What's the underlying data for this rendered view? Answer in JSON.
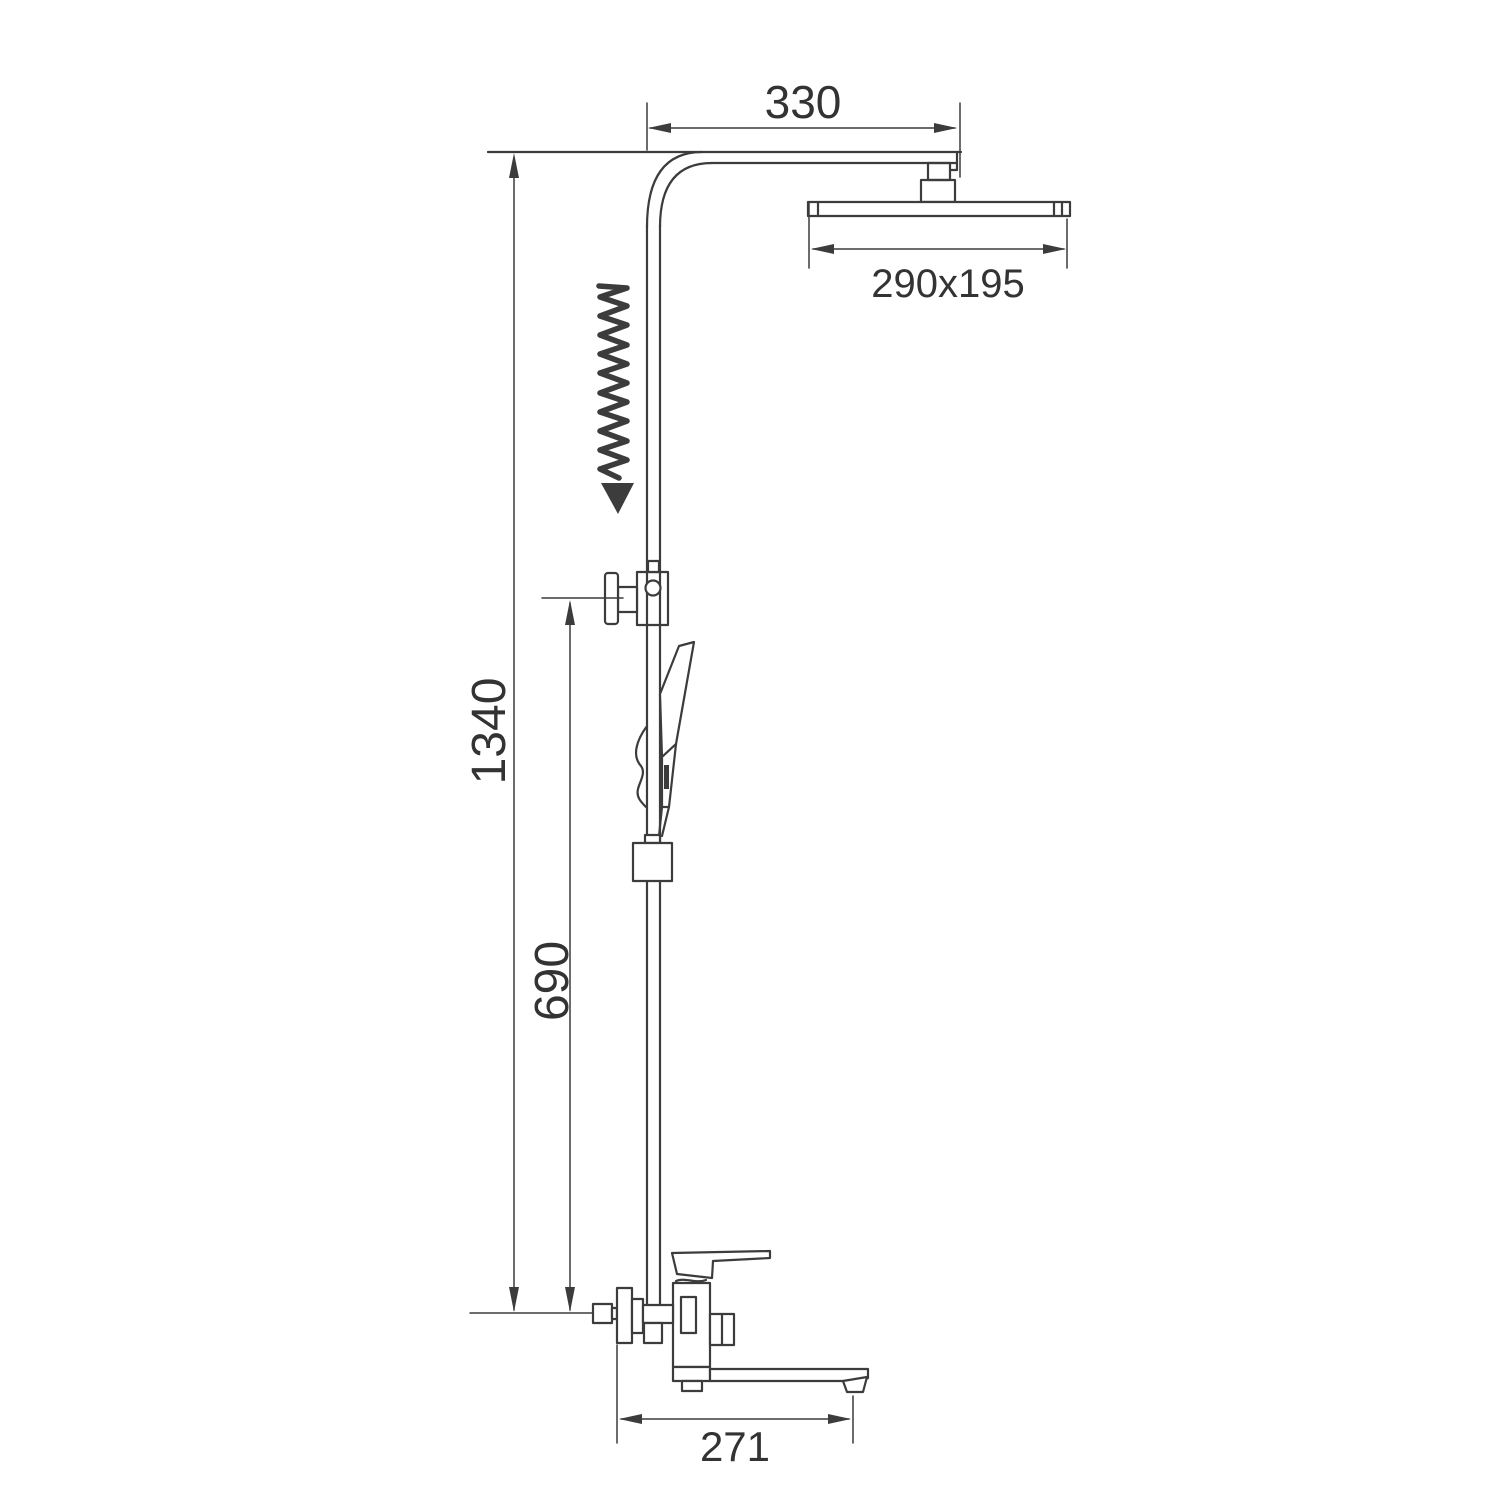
{
  "diagram": {
    "type": "technical-drawing",
    "subject": "thermostatic shower column with rainfall head, hand shower and wall-mounted bath mixer",
    "background": "#ffffff",
    "line_color": "#3c3c3c",
    "text_color": "#333333",
    "labels": {
      "top_width": "330",
      "head_size": "290x195",
      "total_height": "1340",
      "mid_height": "690",
      "spout_reach": "271"
    }
  }
}
